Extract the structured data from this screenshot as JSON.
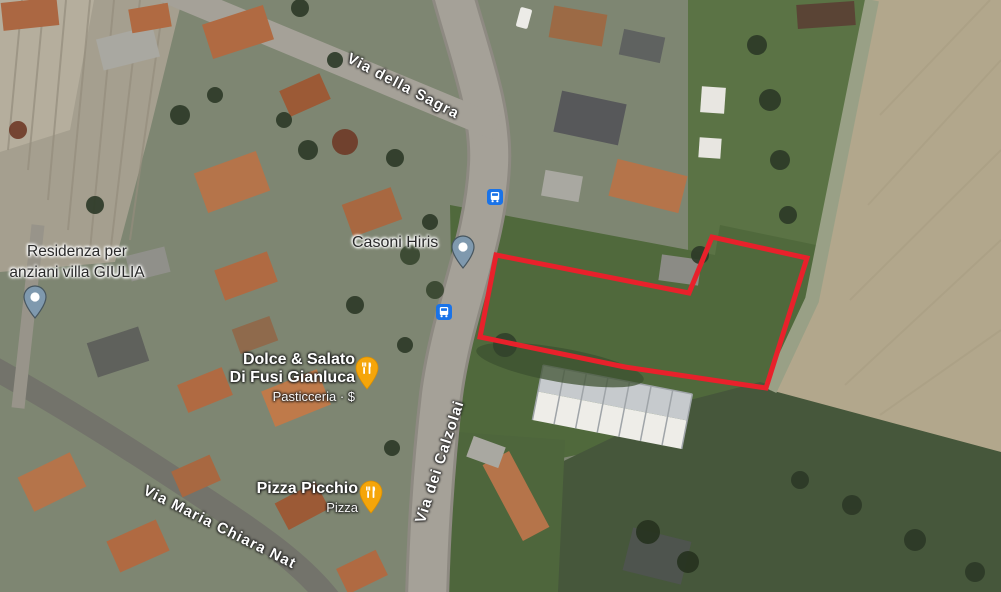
{
  "map": {
    "view": "satellite",
    "streets": {
      "sagra": "Via della Sagra",
      "calzolai": "Via dei Calzolai",
      "maria": "Via Maria Chiara Nat"
    },
    "places": {
      "casoni": "Casoni Hiris",
      "residenza_line1": "Residenza per",
      "residenza_line2": "anziani villa GIULIA"
    },
    "pois": {
      "dolce_line1": "Dolce & Salato",
      "dolce_line2": "Di Fusi Gianluca",
      "dolce_category": "Pasticceria · $",
      "pizza_name": "Pizza Picchio",
      "pizza_category": "Pizza"
    },
    "transit": {
      "bus_stop_count": 2
    },
    "parcel": {
      "points": "496,255 689,293 712,237 807,258 766,388 625,367 480,337",
      "stroke_color": "#e8212b",
      "stroke_width": 5
    },
    "colors": {
      "place_pin": "#7f99ae",
      "restaurant_pin": "#f5a50a",
      "bus_icon_bg": "#1a73e8",
      "field_green": "#50693c",
      "field_tan": "#b2a78c"
    }
  }
}
